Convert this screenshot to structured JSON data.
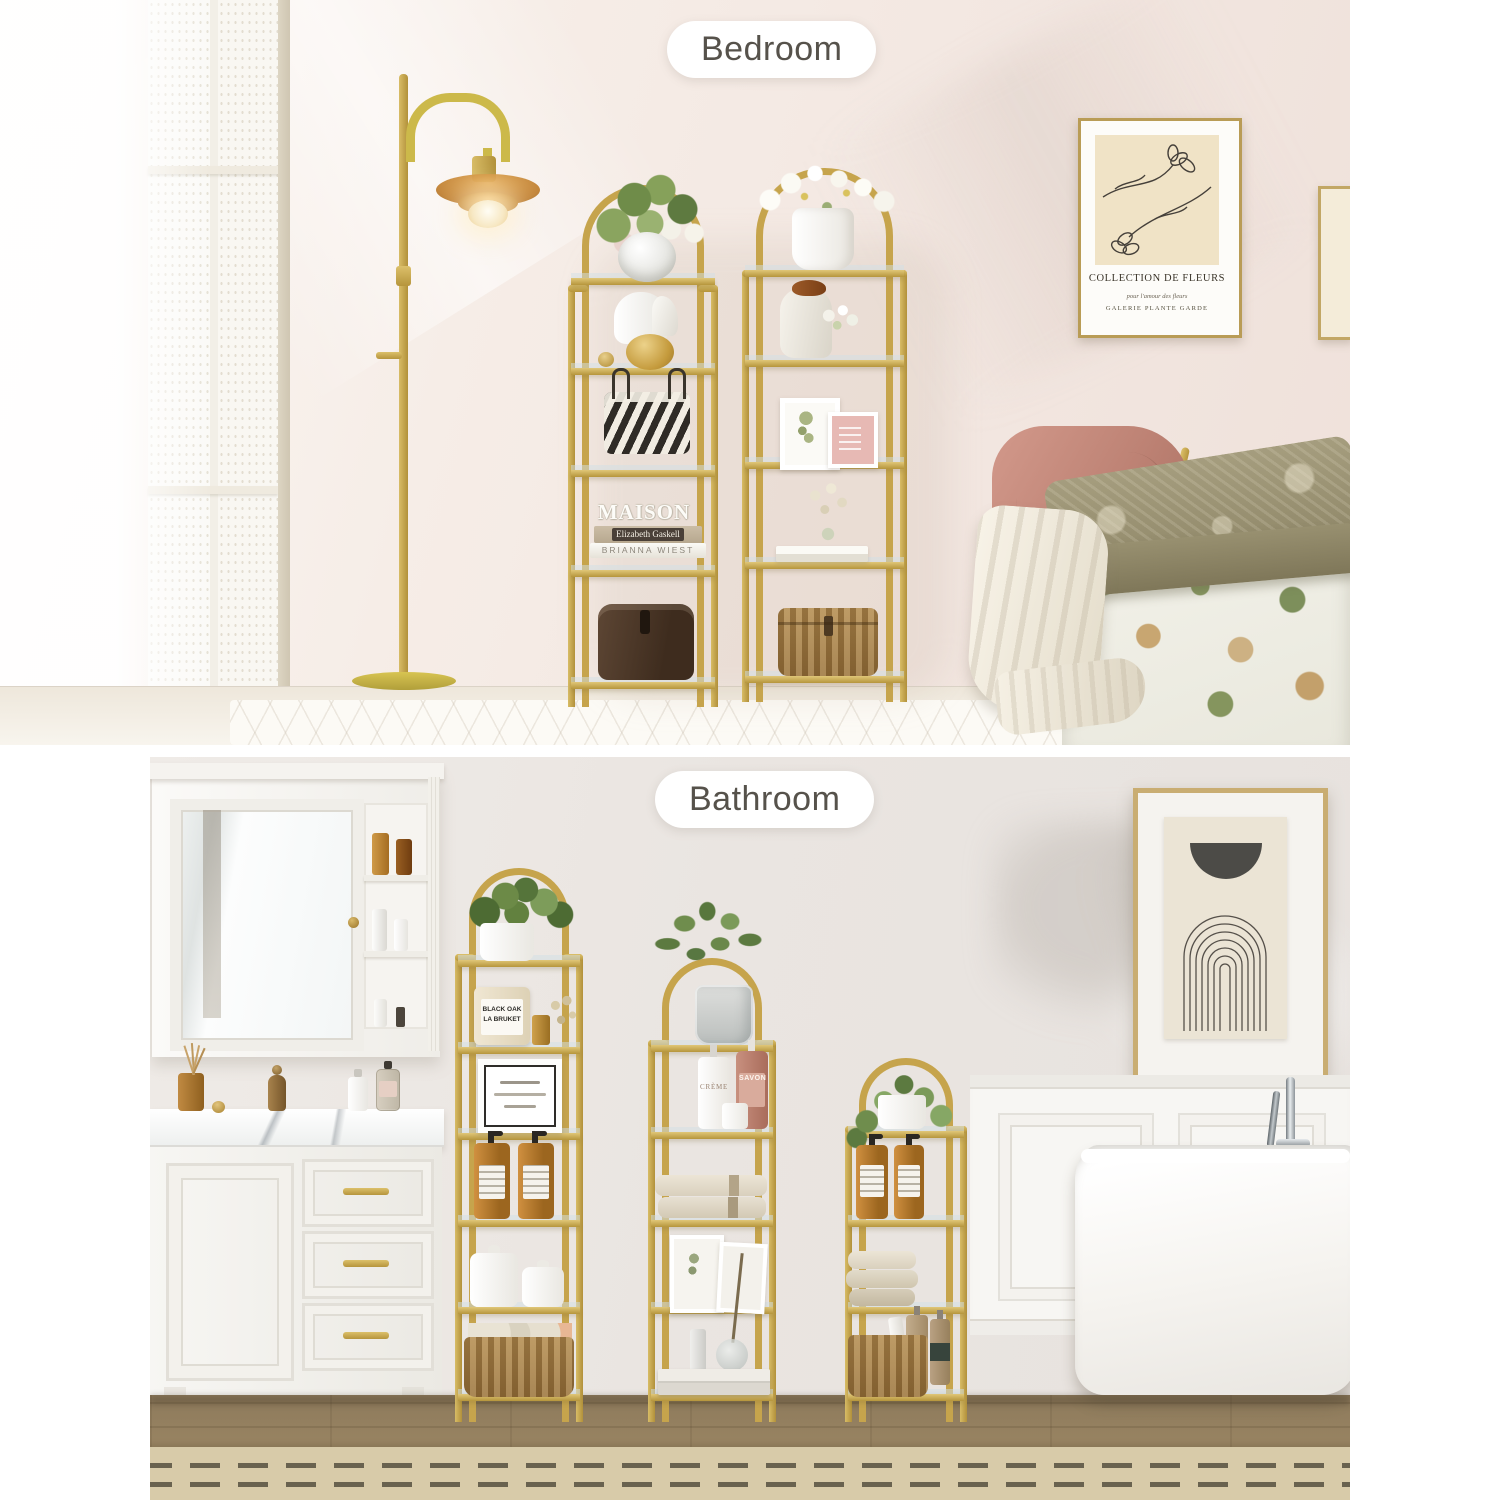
{
  "labels": {
    "bedroom": "Bedroom",
    "bathroom": "Bathroom"
  },
  "bedroom": {
    "wall_art": {
      "title": "COLLECTION DE FLEURS",
      "line2": "pour l'amour des fleurs",
      "line3": "GALERIE PLANTE GARDE"
    },
    "shelf_books": {
      "decor_text": "MAISON",
      "spine1": "Elizabeth Gaskell",
      "spine2": "BRIANNA WIEST"
    }
  },
  "bathroom": {
    "candle": {
      "line1": "BLACK OAK",
      "line2": "LA BRUKET"
    },
    "bottles": {
      "creme": "CRÈME",
      "savon": "SAVON"
    }
  },
  "palette": {
    "gold": "#c6a44c",
    "gold_light": "#e6cf8a",
    "amber": "#c08134",
    "bedroom_wall": "#f3e9e3",
    "bathroom_wall": "#eae5e1",
    "wood_floor": "#97825f",
    "rug": "#d8cba9",
    "chair_pink": "#c48b7e",
    "pill_text": "#56524b"
  }
}
